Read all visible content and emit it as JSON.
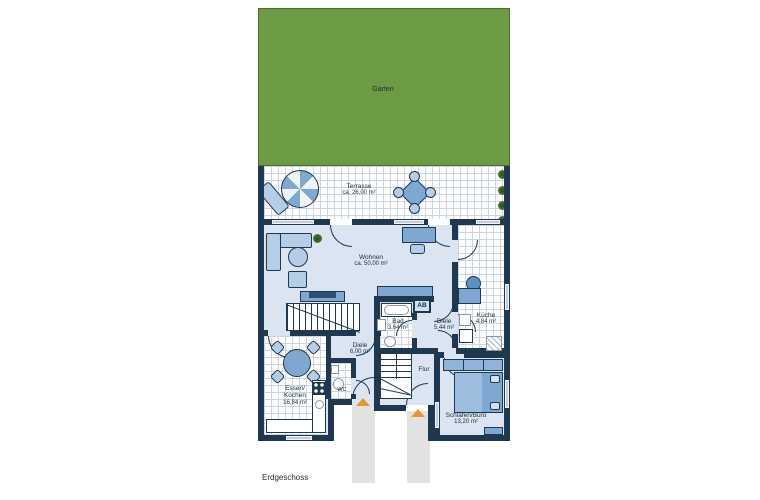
{
  "title": "Erdgeschoss",
  "rooms": {
    "garten": {
      "label": "Garten"
    },
    "terrasse": {
      "label": "Terrasse",
      "area": "ca. 26,00 m²"
    },
    "wohnen": {
      "label": "Wohnen",
      "area": "ca. 50,00 m²"
    },
    "bad": {
      "label": "Bad",
      "area": "3,64 m²"
    },
    "diele_eg": {
      "label": "Diele",
      "area": "5,44 m²"
    },
    "kueche": {
      "label": "Küche",
      "area": "4,84 m²"
    },
    "essen_kochen": {
      "label_line1": "Essen/",
      "label_line2": "Kochen",
      "area": "16,84 m²"
    },
    "diele_2": {
      "label": "Diele",
      "area": "6,00 m²"
    },
    "wc": {
      "label": "WC"
    },
    "flur": {
      "label": "Flur"
    },
    "schlafen_buero": {
      "label": "Schlafen/Büro",
      "area": "13,20 m²"
    }
  },
  "annotations": {
    "ab_label": "AB"
  },
  "colors": {
    "wall_navy": "#1e3851",
    "floor_blue": "#dbe5f1",
    "tile_grid": "#ccd6e3",
    "garden_green": "#6d9b43",
    "furniture_blue": "#7ea8d2",
    "furniture_light_blue": "#b5cde7",
    "entrance_arrow_orange": "#e8962e",
    "path_gray": "#e2e2e2"
  }
}
